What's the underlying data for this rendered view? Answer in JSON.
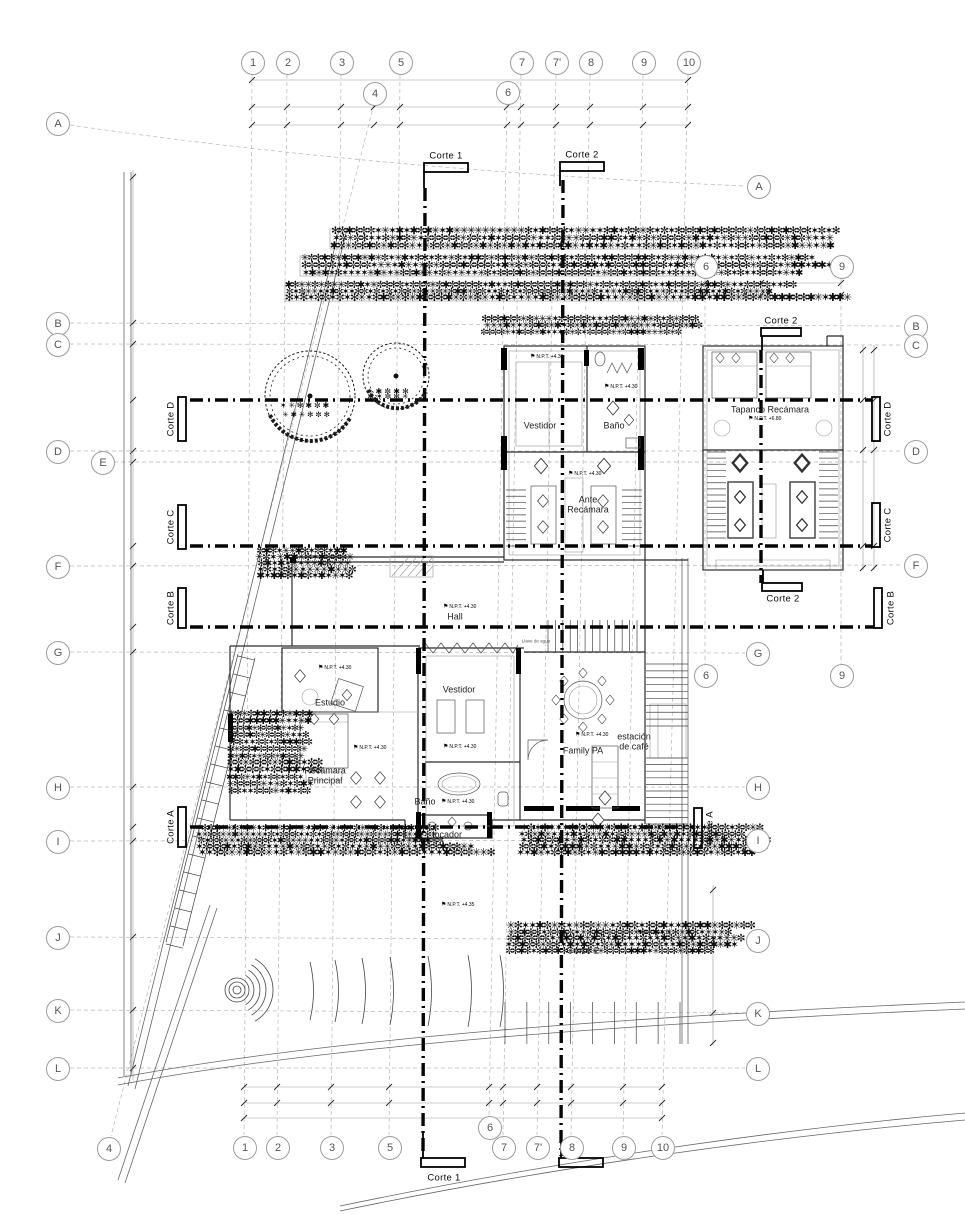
{
  "drawing_type": "architectural floor plan",
  "axes": {
    "top": [
      "1",
      "2",
      "3",
      "5",
      "4",
      "6",
      "7",
      "7'",
      "8",
      "9",
      "10"
    ],
    "bottom": [
      "4",
      "1",
      "2",
      "3",
      "5",
      "6",
      "7",
      "7'",
      "8",
      "9",
      "10"
    ],
    "left": [
      "A",
      "B",
      "C",
      "D",
      "E",
      "F",
      "G",
      "H",
      "I",
      "J",
      "K",
      "L"
    ],
    "right": [
      "A",
      "B",
      "C",
      "D",
      "F",
      "G",
      "H",
      "I",
      "J",
      "K",
      "L"
    ],
    "tapanco": [
      "6",
      "9",
      "6",
      "9"
    ]
  },
  "sections": {
    "corte_1": "Corte 1",
    "corte_2": "Corte 2",
    "corte_a": "Corte A",
    "corte_b": "Corte B",
    "corte_c": "Corte C",
    "corte_d": "Corte D"
  },
  "rooms": {
    "vestidor_top": "Vestidor",
    "bano_top": "Baño",
    "ante": [
      "Ante",
      "Recámara"
    ],
    "tapanco": "Tapanco Recámara",
    "hall": "Hall",
    "estudio": "Estudio",
    "recamara": [
      "Recámara",
      "Principal"
    ],
    "vestidor_center": "Vestidor",
    "family": "Family PA",
    "estacion": [
      "estación",
      "de café"
    ],
    "bano_lower": "Baño",
    "tocador": "tocador"
  },
  "levels": {
    "v430": "N.P.T. +4.30",
    "v435": "N.P.T. +4.35",
    "v515": "N.P.T. +5.15",
    "v680": "N.P.T. +6.80"
  },
  "annotations": {
    "llave": "Llave de agua"
  }
}
